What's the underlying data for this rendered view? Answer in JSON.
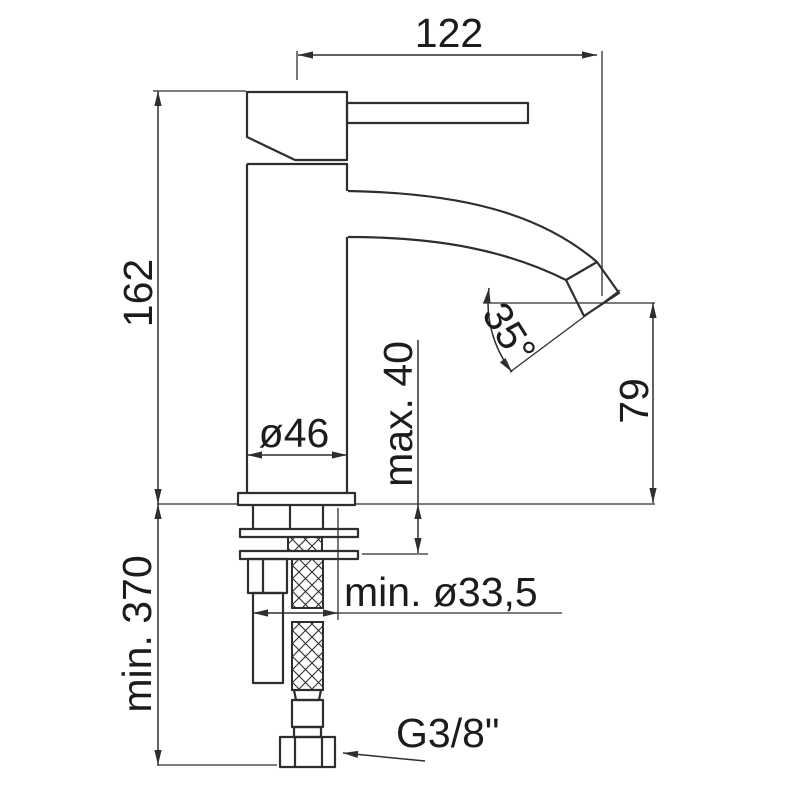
{
  "drawing": {
    "title": "single-lever basin mixer tap - dimensioned side elevation",
    "background": "#ffffff",
    "line_color": "#2e2e2e",
    "labels": {
      "spout_reach": "122",
      "total_height": "162",
      "body_diameter": "ø46",
      "max_deck_thickness": "max. 40",
      "spout_angle": "35°",
      "spout_outlet_height": "79",
      "min_hose_length": "min. 370",
      "min_hole_diameter": "min. ø33,5",
      "thread_size": "G3/8\""
    }
  }
}
